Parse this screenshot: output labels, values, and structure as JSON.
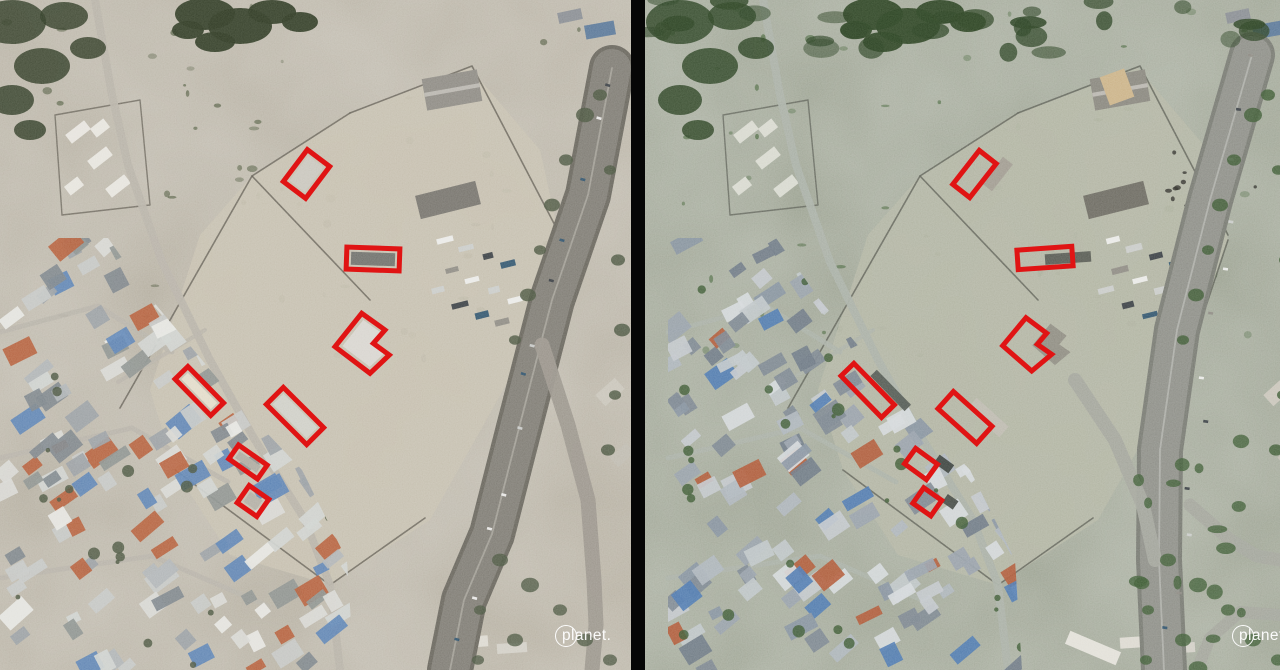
{
  "view": {
    "divider_color": "#060606",
    "annotation": {
      "color": "#e01414",
      "stroke_width": 5
    }
  },
  "panels": [
    {
      "name": "before",
      "logo": "planet.",
      "palette": {
        "base": "#b4aea1",
        "tint": "#d8cfbc",
        "tintOp": 0.1,
        "dirt": "#c7c0b0",
        "wall": "#5b574d",
        "road": "#817e76",
        "roadEdge": "#6b685f",
        "roadMid": "#b8b4aa",
        "branch": "#9b968c",
        "street": "#b7b2a8",
        "treeDark": "#333d28",
        "tree": "#4c5742",
        "bush": "#5a6349",
        "shed": "#8f8c85",
        "shed2": "#79766f",
        "whiteBld": "#e8e6df",
        "roofs": [
          "#d8d8d4",
          "#c6c8c6",
          "#b0b4b6",
          "#9aa0a4",
          "#e6e6e2",
          "#7e858b",
          "#5d83b4",
          "#b55f3d",
          "#8d928f",
          "#cfd2cf"
        ]
      },
      "annotations": [
        {
          "type": "rect",
          "cx": 306.5,
          "cy": 174,
          "w": 40,
          "h": 28,
          "angle": -53,
          "roof": "#c9c6bd"
        },
        {
          "type": "rect",
          "cx": 373,
          "cy": 259,
          "w": 53,
          "h": 22,
          "angle": 2,
          "roof": "#70716b"
        },
        {
          "type": "polygon",
          "points": [
            [
              361.7,
              313.3
            ],
            [
              385,
              330
            ],
            [
              373.3,
              343.3
            ],
            [
              389.3,
              355
            ],
            [
              370,
              373.3
            ],
            [
              335,
              346.7
            ]
          ],
          "roof": "#d9d6cf"
        },
        {
          "type": "rect",
          "cx": 199.3,
          "cy": 391,
          "w": 51,
          "h": 18,
          "angle": 45.6,
          "roof": "#e3dcc9"
        },
        {
          "type": "rect",
          "cx": 295,
          "cy": 416,
          "w": 57,
          "h": 24,
          "angle": 45,
          "roof": "#d0cfc7"
        },
        {
          "type": "rect",
          "cx": 248,
          "cy": 462,
          "w": 35,
          "h": 17,
          "angle": 35,
          "roof": "#aeaaa0"
        },
        {
          "type": "rect",
          "cx": 253,
          "cy": 501,
          "w": 24,
          "h": 21,
          "angle": 35,
          "roof": "#b3aea4"
        }
      ]
    },
    {
      "name": "after",
      "logo": "planet.",
      "palette": {
        "base": "#a3a799",
        "tint": "#7e9671",
        "tintOp": 0.12,
        "dirt": "#b3b5a4",
        "wall": "#54574e",
        "road": "#8f9089",
        "roadEdge": "#797b73",
        "roadMid": "#c0c2ba",
        "branch": "#a3a59c",
        "street": "#aab0a6",
        "treeDark": "#2e4426",
        "tree": "#3f5c36",
        "bush": "#4d6a42",
        "shed": "#8a887f",
        "shed2": "#6f6d64",
        "whiteBld": "#dadbd2",
        "roofs": [
          "#c2c7cb",
          "#aeb5bc",
          "#98a1aa",
          "#8793a0",
          "#d4d8da",
          "#6f7a85",
          "#4f7ab0",
          "#b05a3a",
          "#7d8790",
          "#bfc5c8"
        ]
      },
      "annotations": [
        {
          "type": "rect",
          "cx": 329.5,
          "cy": 174,
          "w": 43,
          "h": 21.5,
          "angle": -52,
          "roof": "#a09b91"
        },
        {
          "type": "rect",
          "cx": 400,
          "cy": 258,
          "w": 55,
          "h": 19.5,
          "angle": -4,
          "roof": "#585b54"
        },
        {
          "type": "polygon",
          "points": [
            [
              381,
              317.7
            ],
            [
              401.7,
              333.3
            ],
            [
              392.3,
              344.3
            ],
            [
              406.7,
              354.3
            ],
            [
              386.7,
              371
            ],
            [
              357.7,
              345.7
            ]
          ],
          "roof": "#8e8c82"
        },
        {
          "type": "rect",
          "cx": 222.7,
          "cy": 390.4,
          "w": 58,
          "h": 18,
          "angle": 45.7,
          "roof": "#555b55"
        },
        {
          "type": "rect",
          "cx": 320,
          "cy": 417.5,
          "w": 52,
          "h": 23,
          "angle": 42,
          "roof": "#bdbab0"
        },
        {
          "type": "rect",
          "cx": 276,
          "cy": 464,
          "w": 27,
          "h": 19,
          "angle": 36,
          "roof": "#3e4440"
        },
        {
          "type": "rect",
          "cx": 282.3,
          "cy": 501.8,
          "w": 22,
          "h": 19,
          "angle": 35,
          "roof": "#474c47"
        }
      ]
    }
  ]
}
